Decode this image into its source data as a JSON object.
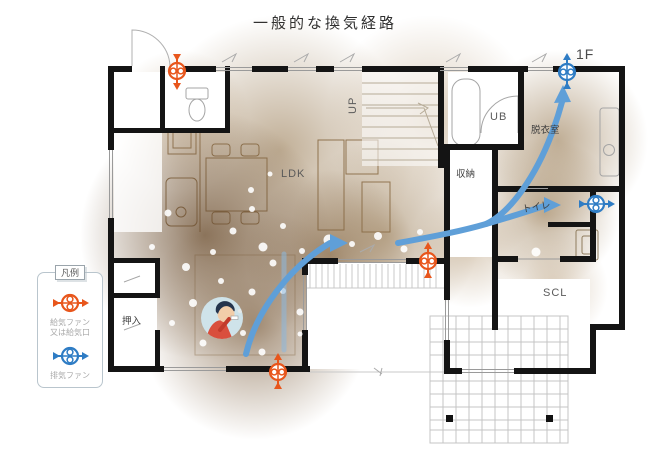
{
  "title": "一般的な換気経路",
  "floor_label": "1F",
  "legend": {
    "header": "凡例",
    "supply_label": "給気ファン\n又は給気口",
    "exhaust_label": "排気ファン"
  },
  "rooms": {
    "ldk": "LDK",
    "up": "UP",
    "ub": "UB",
    "dressing": "脱衣室",
    "storage": "収納",
    "toilet": "トイレ",
    "closet": "押入",
    "scl": "SCL"
  },
  "colors": {
    "supply_fan": "#e8561c",
    "exhaust_fan": "#2e7cc4",
    "flow_arrow": "#5f9fd8",
    "shade_core": "#6f5234",
    "wall": "#141414"
  }
}
